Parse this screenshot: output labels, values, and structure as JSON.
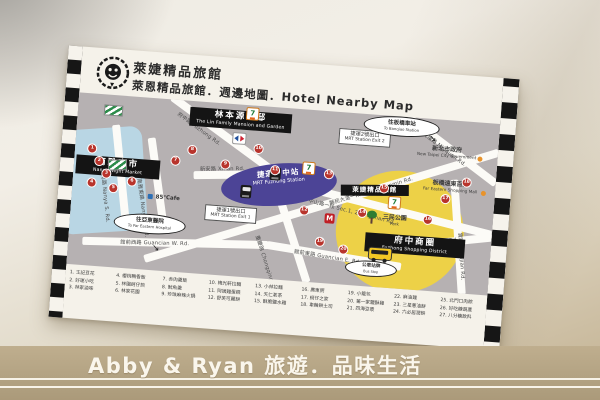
{
  "header": {
    "line1": "萊婕精品旅館",
    "line2": "萊恩精品旅館．週邊地圖．Hotel Nearby Map"
  },
  "map": {
    "areas": {
      "night_market": {
        "zh": "南雅夜市",
        "en": "Nanya Night Market"
      },
      "lin_garden": {
        "zh": "林本源園邸",
        "en": "The Lin Family Mansion and Garden"
      },
      "mrt_station": {
        "zh": "捷運府中站",
        "en": "MRT Fuzhong Station"
      },
      "exit1": {
        "zh": "捷運1號出口",
        "en": "MRT Station Exit 1"
      },
      "exit2": {
        "zh": "捷運2號出口",
        "en": "MRT Station Exit 2"
      },
      "hotel_marker": {
        "zh": "萊婕精品旅館"
      },
      "city_gov": {
        "zh": "新北市政府",
        "en": "New Taipei City Government"
      },
      "far_eastern": {
        "zh": "板橋遠東百貨",
        "en": "Far Eastern Shopping Mall"
      },
      "park": {
        "zh": "三民公園",
        "en": "Park"
      },
      "shopping_district": {
        "zh": "府中商圈",
        "en": "Fuzhong Shopping District"
      },
      "cafe": "85°Cafe"
    },
    "balloons": {
      "hospital": {
        "zh": "往亞東醫院",
        "en": "To Far Eastern Hospital"
      },
      "station": {
        "zh": "往板橋車站",
        "en": "To Banqiao Station"
      },
      "bus_stop": {
        "zh": "公車站牌",
        "en": "Bus Stop"
      }
    },
    "roads": {
      "fuzhong": "府中路 Fuzhong Rd.",
      "xianmin": "縣民大道一段 Sec.1, Xianmin Rd.",
      "zhongshan": "中山路一段 Sec.1, Zhongshan Rd.",
      "chongqing": "重慶路 Chongqing Rd.",
      "guancian_w": "館前西路 Guancian W. Rd.",
      "guancian_e": "館前東路 Guancian E. Rd.",
      "minquan": "民權路 Minquan Rd.",
      "minzu": "民族路 Minzu Rd.",
      "nanya_e": "南雅東路 Nanya E. Rd.",
      "nanya_s": "南雅南路 Nanya S. Rd.",
      "xinan": "新安路 Xinan Rd.",
      "shijian": "實踐路 Shijian Rd."
    },
    "icons": {
      "seven_glyph": "7",
      "mos_glyph": "M"
    },
    "markers": [
      "1",
      "2",
      "3",
      "4",
      "5",
      "6",
      "7",
      "8",
      "9",
      "10",
      "11",
      "12",
      "13",
      "14",
      "15",
      "16",
      "17",
      "18",
      "19",
      "20"
    ]
  },
  "legend": {
    "items": [
      "1. 王記豆花",
      "2. 好運小吃",
      "3. 林家滷味",
      "4. 櫻桃鴨香飯",
      "5. 林園蚵仔煎",
      "6. 林家花園",
      "7. 赤肉羹飯",
      "8. 魷魚羹",
      "9. 珍珠麻辣火鍋",
      "10. 梅光軒拉麵",
      "11. 阿姨雞蛋糕",
      "12. 舒芙可麗餅",
      "13. 小林拉麵",
      "14. 天仁茗茶",
      "15. 酥脆鹽水雞",
      "16. 廣東粥",
      "17. 蚵仔之家",
      "18. 車輪餅土司",
      "19. 小籠包",
      "20. 第一家鹽酥雞",
      "21. 四海豆漿",
      "22. 麻油雞",
      "23. 三星蔥油餅",
      "24. 六必居潤餅",
      "25. 北門口肉粽",
      "26. 好吃糖葫蘆",
      "27. 八分糖飲料"
    ]
  },
  "watermark": {
    "text": "Abby & Ryan 旅遊．品味生活"
  }
}
